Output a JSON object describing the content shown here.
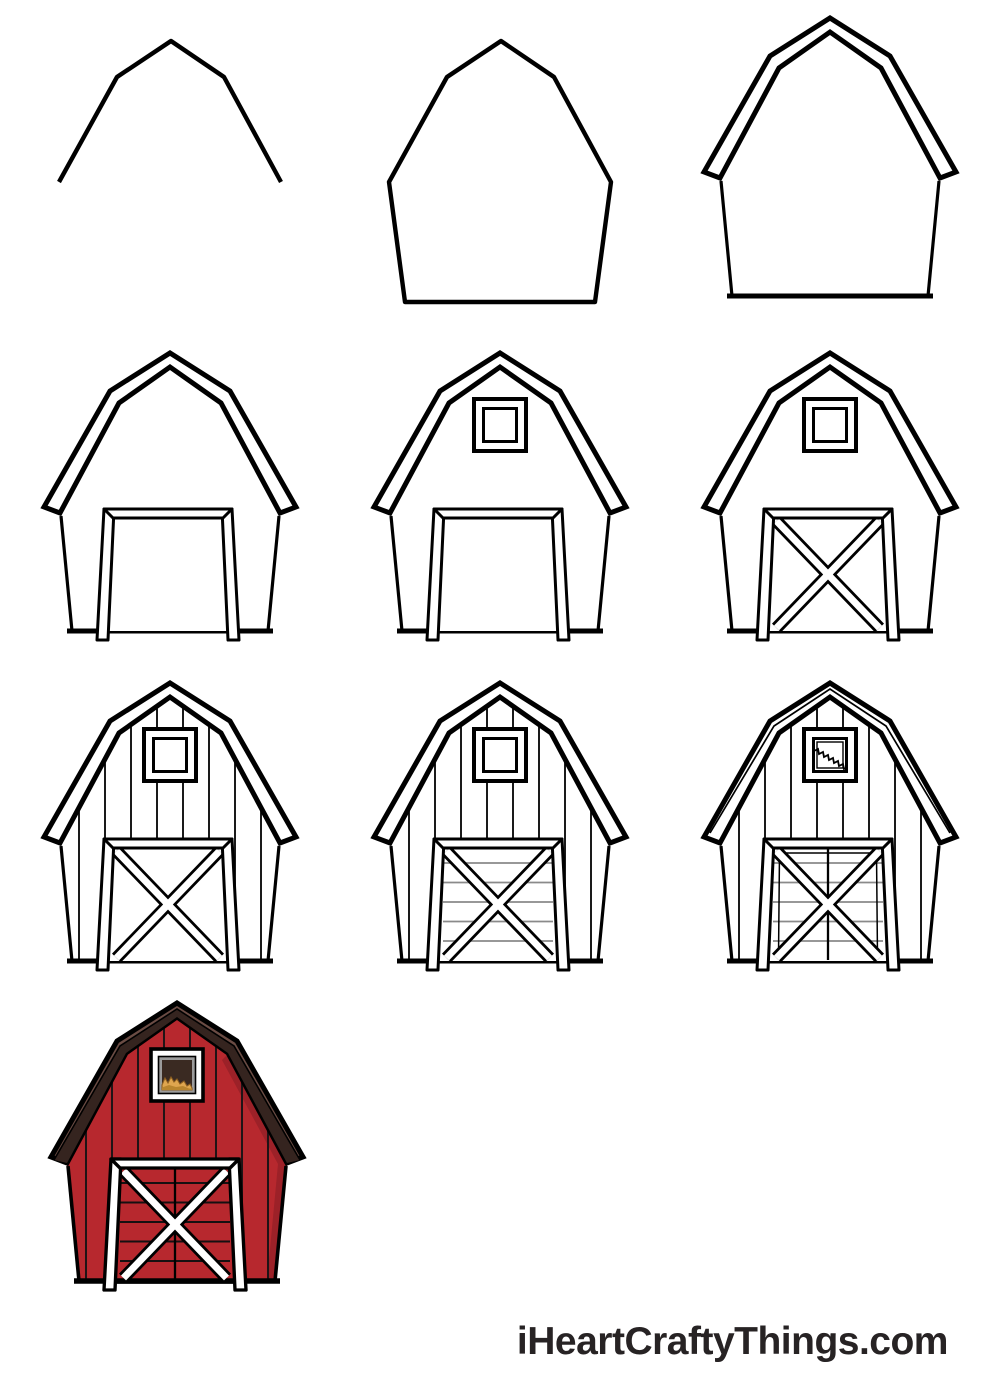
{
  "watermark": {
    "text": "iHeartCraftyThings.com",
    "color": "#272324"
  },
  "palette": {
    "ink": "#000000",
    "paper": "#ffffff",
    "plank_line_gray": "#8a8a8a",
    "barn_red": "#b7282e",
    "barn_red_shade": "#9c2128",
    "roof_dark_brown": "#35241f",
    "roof_light_brown": "#6b4c44",
    "trim_white": "#ffffff",
    "window_bevel_gray": "#9c9c9c",
    "window_interior_brown": "#3a2a22",
    "hay_gold": "#dfa64f",
    "hay_gold_dark": "#b8852e",
    "hay_outline": "#8a5d20",
    "dark_plank_line": "#1f1416"
  },
  "steps": [
    {
      "id": 1,
      "name": "barn-step-1",
      "colored": false,
      "features": [
        "base-roofline"
      ]
    },
    {
      "id": 2,
      "name": "barn-step-2",
      "colored": false,
      "features": [
        "base-outline"
      ]
    },
    {
      "id": 3,
      "name": "barn-step-3",
      "colored": false,
      "features": [
        "eaves-roof",
        "walls"
      ]
    },
    {
      "id": 4,
      "name": "barn-step-4",
      "colored": false,
      "features": [
        "eaves-roof",
        "walls",
        "door"
      ]
    },
    {
      "id": 5,
      "name": "barn-step-5",
      "colored": false,
      "features": [
        "eaves-roof",
        "walls",
        "door",
        "window"
      ]
    },
    {
      "id": 6,
      "name": "barn-step-6",
      "colored": false,
      "features": [
        "eaves-roof",
        "walls",
        "door",
        "window",
        "door-x"
      ]
    },
    {
      "id": 7,
      "name": "barn-step-7",
      "colored": false,
      "features": [
        "eaves-roof",
        "walls",
        "door",
        "window",
        "door-x",
        "wall-planks"
      ]
    },
    {
      "id": 8,
      "name": "barn-step-8",
      "colored": false,
      "features": [
        "eaves-roof",
        "walls",
        "door",
        "window",
        "door-x",
        "wall-planks",
        "door-planks"
      ]
    },
    {
      "id": 9,
      "name": "barn-step-9",
      "colored": false,
      "features": [
        "eaves-roof",
        "walls",
        "door",
        "window",
        "door-x",
        "wall-planks",
        "door-planks",
        "roof-trim",
        "door-split",
        "door-inner-line",
        "window-hay",
        "window-detail"
      ]
    },
    {
      "id": 10,
      "name": "barn-step-10",
      "colored": true,
      "features": [
        "eaves-roof",
        "walls",
        "door",
        "window",
        "door-x",
        "wall-planks",
        "door-planks",
        "door-split",
        "window-hay"
      ]
    }
  ]
}
